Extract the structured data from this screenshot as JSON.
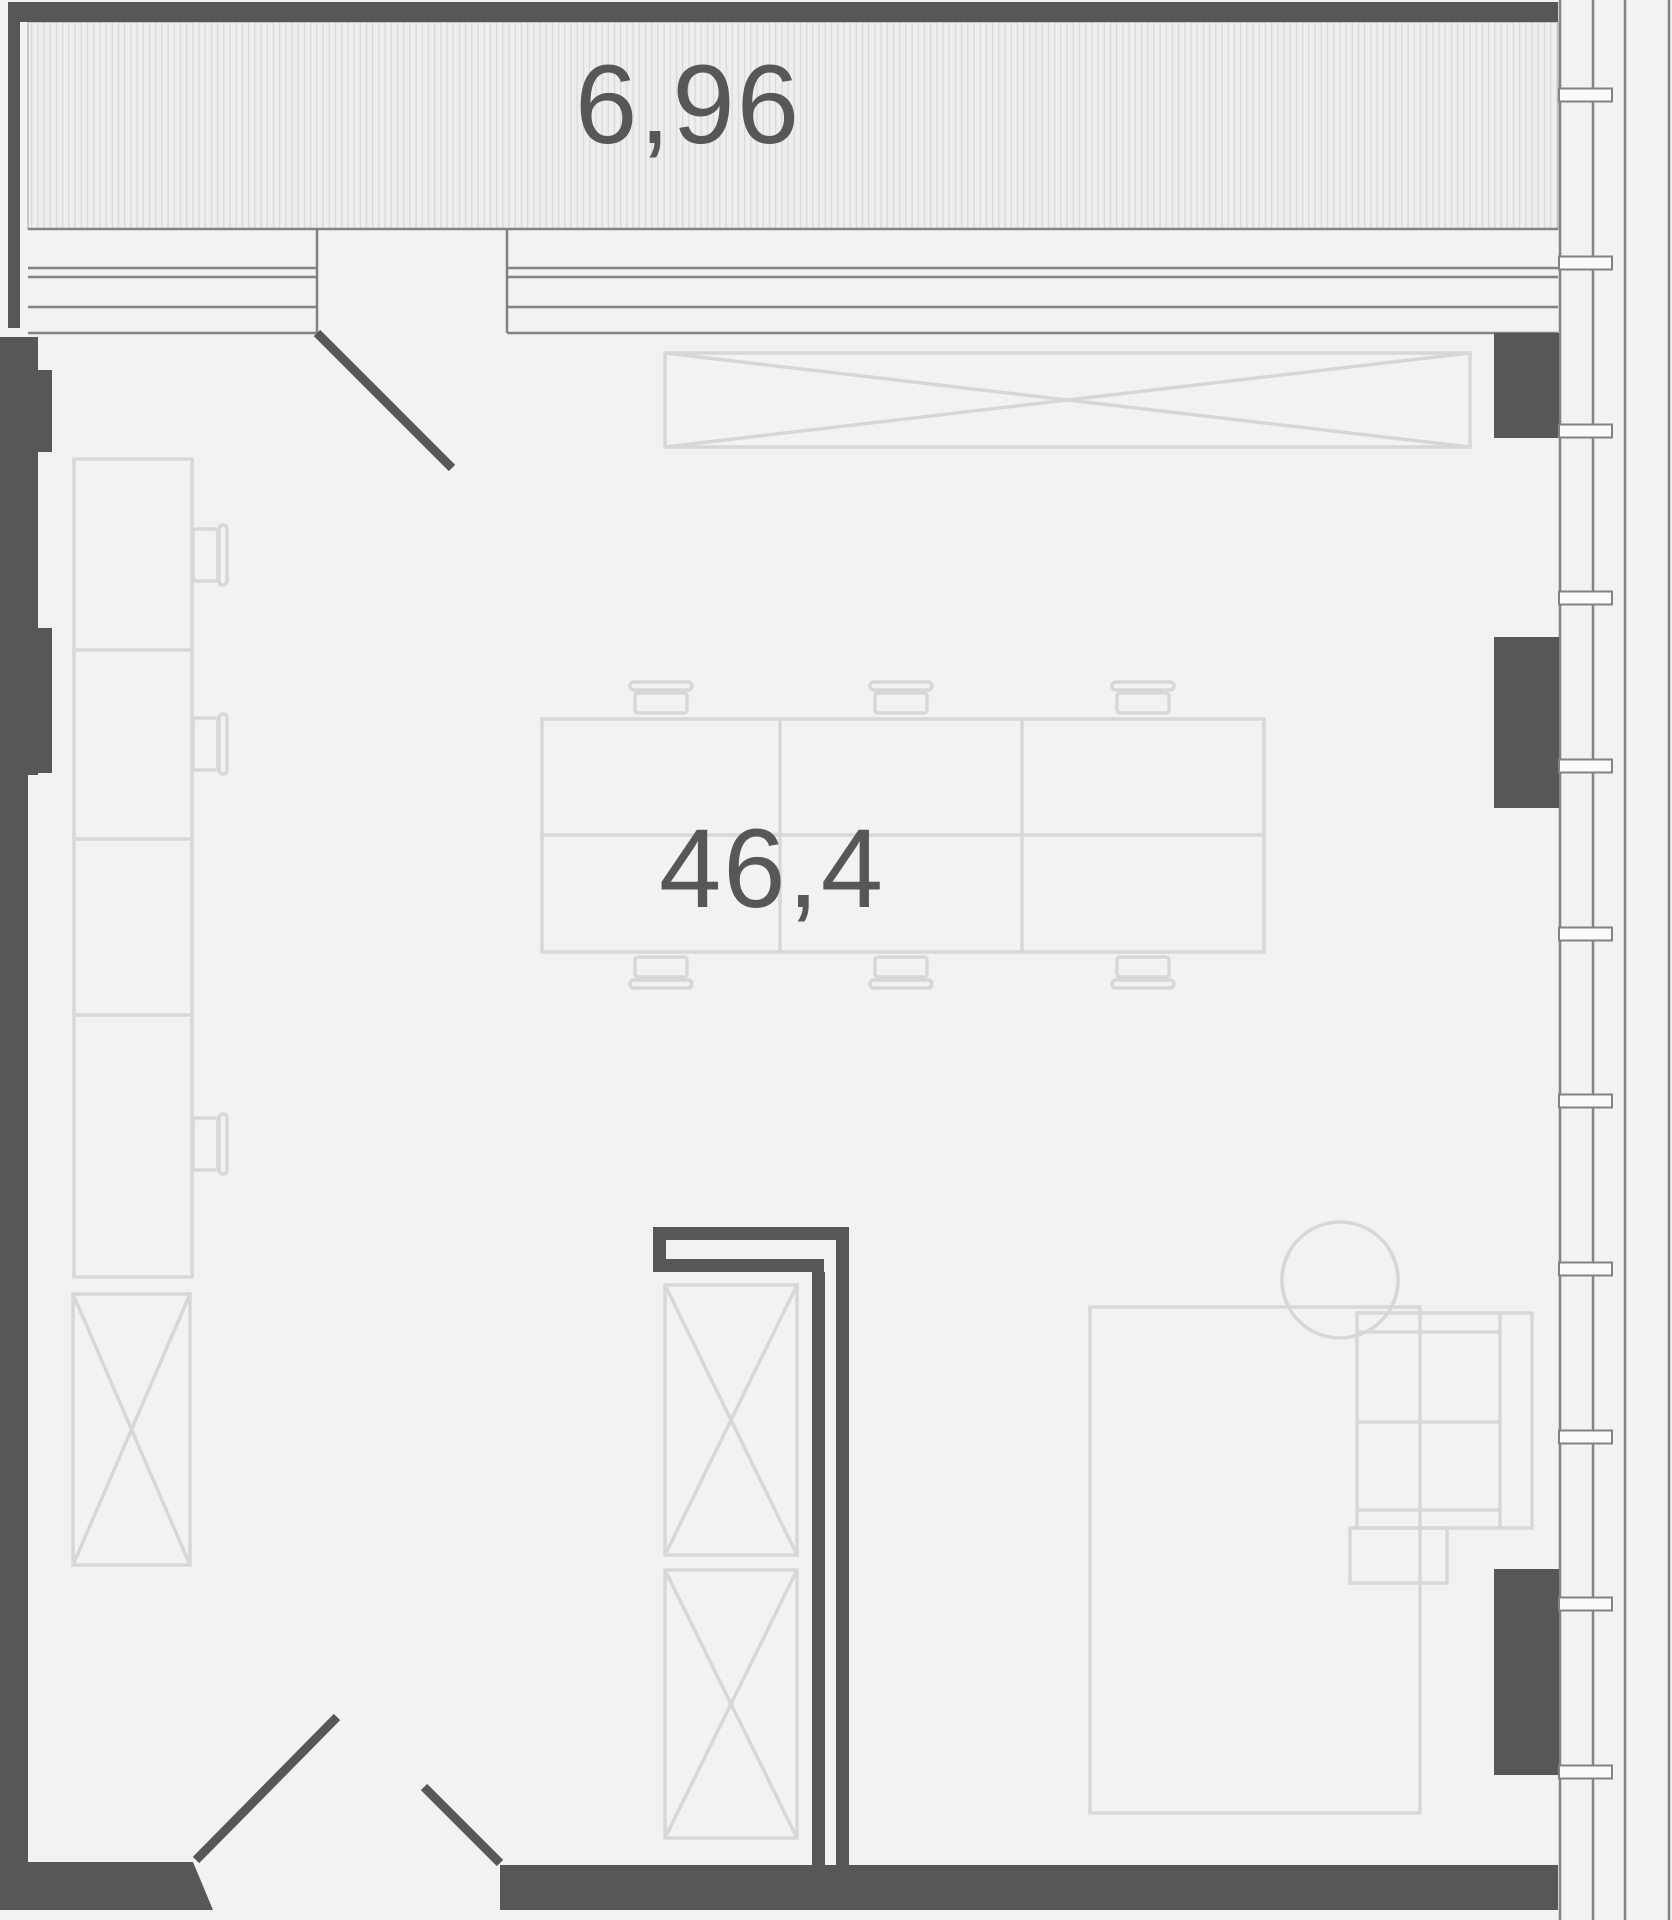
{
  "plan_title": "apartment floor plan",
  "labels": {
    "balcony_area": "6,96",
    "room_area": "46,4"
  },
  "palette": {
    "wall": {
      "fill": "#575756",
      "stroke": "none",
      "w": 0
    },
    "swing": {
      "fill": "none",
      "stroke": "#575756",
      "w": 9
    },
    "band": {
      "fill": "none",
      "stroke": "#83837f",
      "w": 2.5
    },
    "furn": {
      "fill": "none",
      "stroke": "#d7d7d6",
      "w": 3.5
    },
    "sill": {
      "fill": "#fafafa",
      "stroke": "#83837f",
      "w": 2
    },
    "hatchfill": {
      "fill": "url(#hatch)",
      "stroke": "#bbbbba",
      "w": 1.5
    }
  },
  "background": "#f2f2f1",
  "canvas": {
    "width": 1672,
    "height": 1920
  },
  "window_sills": {
    "x": 1559,
    "w": 53,
    "h": 13,
    "centers": [
      95,
      263,
      431,
      598,
      766,
      934,
      1101,
      1269,
      1437,
      1604,
      1772
    ]
  },
  "shapes": [
    {
      "t": "r",
      "n": "balcony-hatch",
      "p": "hatchfill",
      "x": 28,
      "y": 22,
      "w": 1530,
      "h": 207
    },
    {
      "t": "l",
      "n": "balcony-edge-line",
      "p": "band",
      "x1": 28,
      "y1": 229,
      "x2": 1558,
      "y2": 229
    },
    {
      "t": "l",
      "n": "glazing-line",
      "p": "band",
      "x1": 28,
      "y1": 268,
      "x2": 317,
      "y2": 268
    },
    {
      "t": "l",
      "n": "glazing-line",
      "p": "band",
      "x1": 28,
      "y1": 277,
      "x2": 317,
      "y2": 277
    },
    {
      "t": "l",
      "n": "glazing-line",
      "p": "band",
      "x1": 28,
      "y1": 307,
      "x2": 317,
      "y2": 307
    },
    {
      "t": "l",
      "n": "glazing-line",
      "p": "band",
      "x1": 28,
      "y1": 333,
      "x2": 317,
      "y2": 333
    },
    {
      "t": "l",
      "n": "glazing-line",
      "p": "band",
      "x1": 507,
      "y1": 268,
      "x2": 1558,
      "y2": 268
    },
    {
      "t": "l",
      "n": "glazing-line",
      "p": "band",
      "x1": 507,
      "y1": 277,
      "x2": 1558,
      "y2": 277
    },
    {
      "t": "l",
      "n": "glazing-line",
      "p": "band",
      "x1": 507,
      "y1": 307,
      "x2": 1558,
      "y2": 307
    },
    {
      "t": "l",
      "n": "glazing-line",
      "p": "band",
      "x1": 507,
      "y1": 333,
      "x2": 1558,
      "y2": 333
    },
    {
      "t": "l",
      "n": "door-jamb",
      "p": "band",
      "x1": 317,
      "y1": 229,
      "x2": 317,
      "y2": 333
    },
    {
      "t": "l",
      "n": "door-jamb",
      "p": "band",
      "x1": 507,
      "y1": 229,
      "x2": 507,
      "y2": 333
    },
    {
      "t": "l",
      "n": "facade-mullion",
      "p": "band",
      "x1": 1560,
      "y1": 0,
      "x2": 1560,
      "y2": 1920
    },
    {
      "t": "l",
      "n": "facade-mullion",
      "p": "band",
      "x1": 1593,
      "y1": 0,
      "x2": 1593,
      "y2": 1920
    },
    {
      "t": "l",
      "n": "facade-mullion",
      "p": "band",
      "x1": 1625,
      "y1": 0,
      "x2": 1625,
      "y2": 1920
    },
    {
      "t": "l",
      "n": "facade-mullion",
      "p": "band",
      "x1": 1669,
      "y1": 0,
      "x2": 1669,
      "y2": 1920
    },
    {
      "t": "x",
      "n": "console-crossbox",
      "p": "furn",
      "x": 665,
      "y": 353,
      "w": 805,
      "h": 94
    },
    {
      "t": "r",
      "n": "desk-grid",
      "p": "furn",
      "x": 542,
      "y": 719,
      "w": 722,
      "h": 233
    },
    {
      "t": "l",
      "n": "desk-divider",
      "p": "furn",
      "x1": 780,
      "y1": 719,
      "x2": 780,
      "y2": 952
    },
    {
      "t": "l",
      "n": "desk-divider",
      "p": "furn",
      "x1": 1022,
      "y1": 719,
      "x2": 1022,
      "y2": 952
    },
    {
      "t": "l",
      "n": "desk-divider",
      "p": "furn",
      "x1": 542,
      "y1": 835,
      "x2": 1264,
      "y2": 835
    },
    {
      "t": "r",
      "n": "chair-back",
      "p": "furn",
      "x": 630,
      "y": 682,
      "w": 62,
      "h": 8,
      "rx": 4
    },
    {
      "t": "r",
      "n": "chair-seat",
      "p": "furn",
      "x": 635,
      "y": 693,
      "w": 52,
      "h": 20,
      "rx": 3
    },
    {
      "t": "r",
      "n": "chair-back",
      "p": "furn",
      "x": 870,
      "y": 682,
      "w": 62,
      "h": 8,
      "rx": 4
    },
    {
      "t": "r",
      "n": "chair-seat",
      "p": "furn",
      "x": 875,
      "y": 693,
      "w": 52,
      "h": 20,
      "rx": 3
    },
    {
      "t": "r",
      "n": "chair-back",
      "p": "furn",
      "x": 1112,
      "y": 682,
      "w": 62,
      "h": 8,
      "rx": 4
    },
    {
      "t": "r",
      "n": "chair-seat",
      "p": "furn",
      "x": 1117,
      "y": 693,
      "w": 52,
      "h": 20,
      "rx": 3
    },
    {
      "t": "r",
      "n": "chair-seat",
      "p": "furn",
      "x": 635,
      "y": 957,
      "w": 52,
      "h": 20,
      "rx": 3
    },
    {
      "t": "r",
      "n": "chair-back",
      "p": "furn",
      "x": 630,
      "y": 980,
      "w": 62,
      "h": 8,
      "rx": 4
    },
    {
      "t": "r",
      "n": "chair-seat",
      "p": "furn",
      "x": 875,
      "y": 957,
      "w": 52,
      "h": 20,
      "rx": 3
    },
    {
      "t": "r",
      "n": "chair-back",
      "p": "furn",
      "x": 870,
      "y": 980,
      "w": 62,
      "h": 8,
      "rx": 4
    },
    {
      "t": "r",
      "n": "chair-seat",
      "p": "furn",
      "x": 1117,
      "y": 957,
      "w": 52,
      "h": 20,
      "rx": 3
    },
    {
      "t": "r",
      "n": "chair-back",
      "p": "furn",
      "x": 1112,
      "y": 980,
      "w": 62,
      "h": 8,
      "rx": 4
    },
    {
      "t": "r",
      "n": "side-desk-column",
      "p": "furn",
      "x": 74,
      "y": 459,
      "w": 118,
      "h": 818
    },
    {
      "t": "l",
      "n": "side-desk-divider",
      "p": "furn",
      "x1": 74,
      "y1": 650,
      "x2": 192,
      "y2": 650
    },
    {
      "t": "l",
      "n": "side-desk-divider",
      "p": "furn",
      "x1": 74,
      "y1": 839,
      "x2": 192,
      "y2": 839
    },
    {
      "t": "l",
      "n": "side-desk-divider",
      "p": "furn",
      "x1": 74,
      "y1": 1015,
      "x2": 192,
      "y2": 1015
    },
    {
      "t": "r",
      "n": "chair-seat",
      "p": "furn",
      "x": 193,
      "y": 529,
      "w": 25,
      "h": 52,
      "rx": 3
    },
    {
      "t": "r",
      "n": "chair-back",
      "p": "furn",
      "x": 219,
      "y": 525,
      "w": 8,
      "h": 60,
      "rx": 4
    },
    {
      "t": "r",
      "n": "chair-seat",
      "p": "furn",
      "x": 193,
      "y": 718,
      "w": 25,
      "h": 52,
      "rx": 3
    },
    {
      "t": "r",
      "n": "chair-back",
      "p": "furn",
      "x": 219,
      "y": 714,
      "w": 8,
      "h": 60,
      "rx": 4
    },
    {
      "t": "r",
      "n": "chair-seat",
      "p": "furn",
      "x": 193,
      "y": 1118,
      "w": 25,
      "h": 52,
      "rx": 3
    },
    {
      "t": "r",
      "n": "chair-back",
      "p": "furn",
      "x": 219,
      "y": 1114,
      "w": 8,
      "h": 60,
      "rx": 4
    },
    {
      "t": "x",
      "n": "cabinet-crossbox",
      "p": "furn",
      "x": 73,
      "y": 1294,
      "w": 117,
      "h": 271
    },
    {
      "t": "x",
      "n": "shelf-crossbox-1",
      "p": "furn",
      "x": 665,
      "y": 1285,
      "w": 132,
      "h": 270
    },
    {
      "t": "x",
      "n": "shelf-crossbox-2",
      "p": "furn",
      "x": 665,
      "y": 1570,
      "w": 132,
      "h": 268
    },
    {
      "t": "r",
      "n": "island-table",
      "p": "furn",
      "x": 1090,
      "y": 1307,
      "w": 330,
      "h": 506
    },
    {
      "t": "r",
      "n": "side-table",
      "p": "furn",
      "x": 1350,
      "y": 1528,
      "w": 97,
      "h": 55
    },
    {
      "t": "c",
      "n": "round-table",
      "p": "furn",
      "cx": 1340,
      "cy": 1280,
      "r": 58
    },
    {
      "t": "r",
      "n": "sofa-outline",
      "p": "furn",
      "x": 1357,
      "y": 1313,
      "w": 175,
      "h": 215
    },
    {
      "t": "l",
      "n": "sofa-back",
      "p": "furn",
      "x1": 1500,
      "y1": 1313,
      "x2": 1500,
      "y2": 1528
    },
    {
      "t": "l",
      "n": "sofa-armrest",
      "p": "furn",
      "x1": 1357,
      "y1": 1332,
      "x2": 1500,
      "y2": 1332
    },
    {
      "t": "l",
      "n": "sofa-armrest",
      "p": "furn",
      "x1": 1357,
      "y1": 1510,
      "x2": 1500,
      "y2": 1510
    },
    {
      "t": "l",
      "n": "sofa-seat-divider",
      "p": "furn",
      "x1": 1357,
      "y1": 1422,
      "x2": 1500,
      "y2": 1422
    },
    {
      "t": "r",
      "n": "wall-top",
      "p": "wall",
      "x": 8,
      "y": 2,
      "w": 1550,
      "h": 20
    },
    {
      "t": "r",
      "n": "wall-balcony-left",
      "p": "wall",
      "x": 8,
      "y": 2,
      "w": 12,
      "h": 326
    },
    {
      "t": "r",
      "n": "wall-left-upper",
      "p": "wall",
      "x": 0,
      "y": 337,
      "w": 38,
      "h": 438
    },
    {
      "t": "r",
      "n": "wall-left-pier-1",
      "p": "wall",
      "x": 38,
      "y": 370,
      "w": 14,
      "h": 82
    },
    {
      "t": "r",
      "n": "wall-left-pier-2",
      "p": "wall",
      "x": 38,
      "y": 628,
      "w": 14,
      "h": 145
    },
    {
      "t": "r",
      "n": "wall-left-lower",
      "p": "wall",
      "x": 0,
      "y": 775,
      "w": 28,
      "h": 1087
    },
    {
      "t": "g",
      "n": "wall-bottom-left",
      "p": "wall",
      "pts": "0,1862 193,1862 213,1910 0,1910"
    },
    {
      "t": "r",
      "n": "wall-bottom-right",
      "p": "wall",
      "x": 500,
      "y": 1865,
      "w": 1058,
      "h": 45
    },
    {
      "t": "r",
      "n": "wall-right-pier-1",
      "p": "wall",
      "x": 1494,
      "y": 333,
      "w": 65,
      "h": 105
    },
    {
      "t": "r",
      "n": "wall-right-pier-2",
      "p": "wall",
      "x": 1494,
      "y": 637,
      "w": 65,
      "h": 171
    },
    {
      "t": "r",
      "n": "wall-right-pier-3",
      "p": "wall",
      "x": 1494,
      "y": 1569,
      "w": 65,
      "h": 206
    },
    {
      "t": "r",
      "n": "wall-partition-cap-outer",
      "p": "wall",
      "x": 653,
      "y": 1227,
      "w": 196,
      "h": 13
    },
    {
      "t": "r",
      "n": "wall-partition-cap-left",
      "p": "wall",
      "x": 653,
      "y": 1240,
      "w": 13,
      "h": 32
    },
    {
      "t": "r",
      "n": "wall-partition-cap-inner",
      "p": "wall",
      "x": 666,
      "y": 1259,
      "w": 158,
      "h": 13
    },
    {
      "t": "r",
      "n": "wall-partition-left",
      "p": "wall",
      "x": 812,
      "y": 1272,
      "w": 13,
      "h": 593
    },
    {
      "t": "r",
      "n": "wall-partition-right",
      "p": "wall",
      "x": 836,
      "y": 1240,
      "w": 13,
      "h": 625
    },
    {
      "t": "l",
      "n": "door-swing-balcony",
      "p": "swing",
      "x1": 317,
      "y1": 333,
      "x2": 452,
      "y2": 468
    },
    {
      "t": "l",
      "n": "door-swing-entry-left",
      "p": "swing",
      "x1": 196,
      "y1": 1860,
      "x2": 337,
      "y2": 1717
    },
    {
      "t": "l",
      "n": "door-swing-entry-right",
      "p": "swing",
      "x1": 424,
      "y1": 1787,
      "x2": 500,
      "y2": 1863
    }
  ]
}
